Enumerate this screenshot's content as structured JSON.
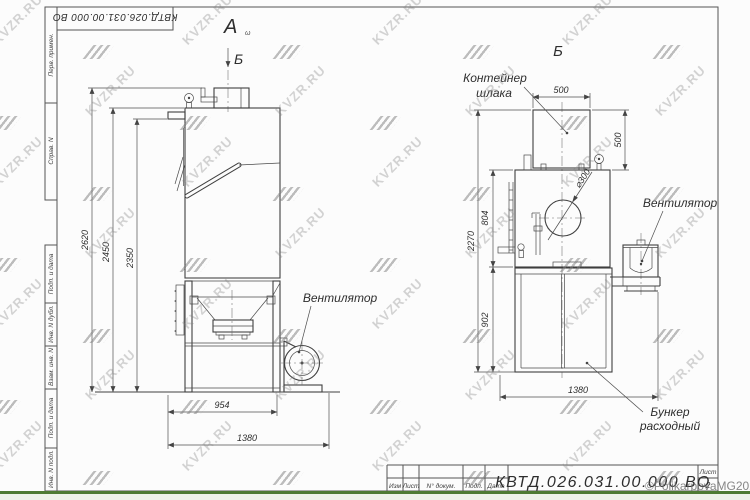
{
  "watermark": {
    "text": "KVZR.RU",
    "copyright": "©PolikarpovaMG2021"
  },
  "frame": {
    "doc_number_top": "КВТД.026.031.00.000 ВО",
    "side_labels": [
      "Перв. примен.",
      "Справ. N",
      "Подп. и дата",
      "Инв. N дубл.",
      "Взам. инв. N",
      "Подп. и дата",
      "Инв. N подл."
    ]
  },
  "title_block": {
    "columns": [
      "Изм",
      "Лист",
      "N° докум.",
      "Подп.",
      "Дата"
    ],
    "doc_number": "КВТД.026.031.00.000 ВО",
    "sheet_label": "Лист",
    "sheet_number": "2"
  },
  "left_view": {
    "view_label": "А",
    "view_label_sub": "ω",
    "section_label": "Б",
    "fan_label": "Вентилятор",
    "dims": {
      "total_height": "2620",
      "body_height": "2450",
      "stub_height": "2350",
      "frame_width": "954",
      "overall_width": "1380"
    }
  },
  "right_view": {
    "title": "Б",
    "container_label": [
      "Контейнер",
      "шлака"
    ],
    "fan_label": "Вентилятор",
    "bunker_label": [
      "Бункер",
      "расходный"
    ],
    "diameter": "⌀300",
    "dims": {
      "container_width": "500",
      "container_height": "500",
      "total_height": "2270",
      "body_height": "804",
      "bunker_height": "902",
      "overall_width": "1380"
    }
  }
}
